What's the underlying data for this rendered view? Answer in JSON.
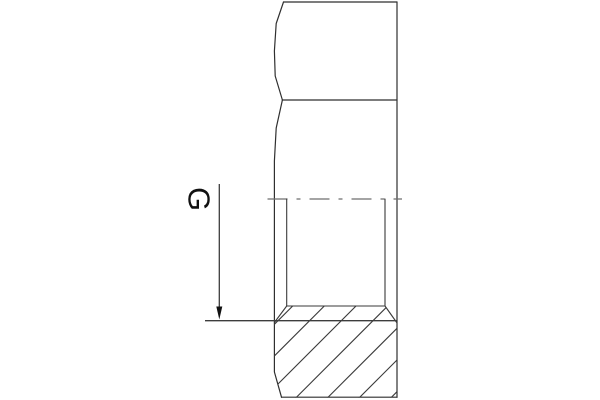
{
  "drawing": {
    "thread_label": "G",
    "colors": {
      "background": "#ffffff",
      "outline": "#2f2f2f",
      "section_lines": "#3a3a3a",
      "centerline": "#6e6e6e",
      "leader": "#3d3d3d",
      "annotation": "#111111"
    }
  }
}
